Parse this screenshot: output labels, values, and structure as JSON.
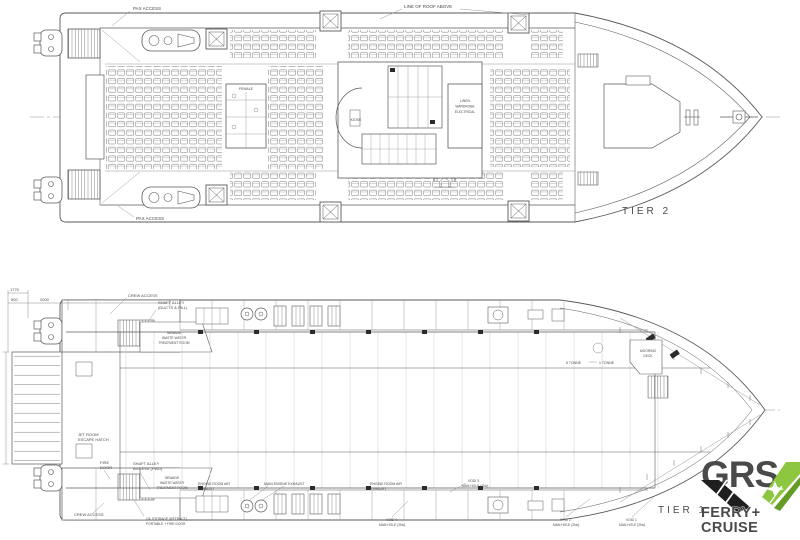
{
  "tier2": {
    "labels": {
      "pax_access_top": "PAX ACCESS",
      "pax_access_bottom": "PAX ACCESS",
      "roof_note": "LINE OF ROOF ABOVE",
      "female": "FEMALE",
      "kiosk": "KIOSK",
      "linen": {
        "l1": "LINEN",
        "l2": "WARDROBE",
        "l3": "ELECTRICAL"
      },
      "tier_label": "TIER 2"
    }
  },
  "tier1": {
    "labels": {
      "crew_access_top": "CREW ACCESS",
      "crew_access_bottom": "CREW ACCESS",
      "shaft_alley_fwd": {
        "l1": "SHAFT ALLEY",
        "l2": "(DUCTS & FILL)"
      },
      "sewage_room": {
        "l1": "SEWAGE",
        "l2": "WASTE WATER",
        "l3": "TREATMENT ROOM"
      },
      "jet_room": {
        "l1": "JET ROOM",
        "l2": "ESCAPE HATCH"
      },
      "fire_door": {
        "l1": "FIRE",
        "l2": "DOOR"
      },
      "shaft_alley_access": {
        "l1": "SHAFT ALLEY",
        "l2": "ACCESS (FWD)"
      },
      "er_air_exhaust": {
        "l1": "ENGINE ROOM AIR",
        "l2": "EXHAUST"
      },
      "main_engine_exhaust": "MAIN ENGINE EXHAUST",
      "void1": {
        "l1": "VOID 1",
        "l2": "MAN HOLE (2No)"
      },
      "void2": {
        "l1": "VOID 2",
        "l2": "MAN HOLE (2No)"
      },
      "void3": {
        "l1": "VOID 3",
        "l2": "MAN HOLE (2No)"
      },
      "void4": {
        "l1": "VOID 4",
        "l2": "MAN HOLE (2No)"
      },
      "oil_storage": {
        "l1": "OIL STORAGE (RETRACT)",
        "l2": "PORTABLE + FIRE DOOR"
      },
      "mooring_deck": {
        "l1": "MOORING",
        "l2": "DECK"
      },
      "tonne5": "5 TONNE",
      "tonne1": "1 TONNE",
      "tier_label": "TIER 1"
    },
    "dimensions": {
      "d1": "1770",
      "d2": "500",
      "d3": "2000"
    }
  },
  "logo": {
    "name": "GRS",
    "line1": "FERRY+",
    "line2": "CRUISE",
    "dark": "#3b3b3d",
    "black": "#1f1f1f",
    "green": "#8dc63f",
    "green_dark": "#649b22",
    "text_green": "#6fa82a"
  }
}
